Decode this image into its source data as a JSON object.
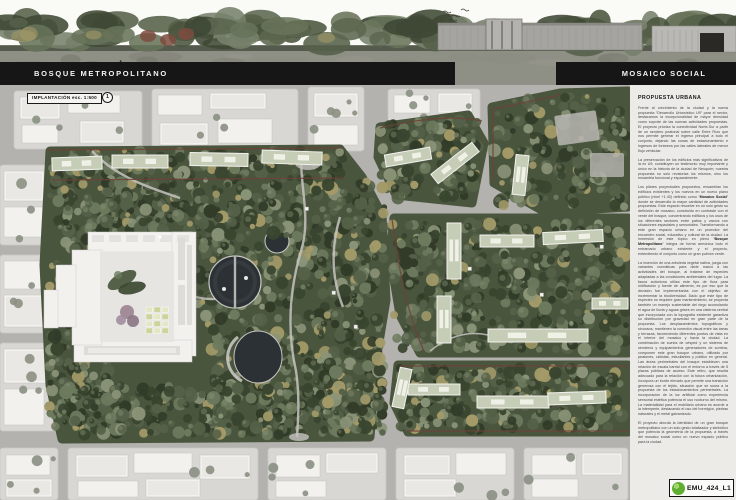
{
  "board": {
    "title_left": "BOSQUE METROPOLITANO",
    "title_right": "MOSAICO SOCIAL",
    "plan_label": "IMPLANTACIÓN esc. 1:500",
    "plan_marker": "1",
    "sheet_code": "EMU_424_L1"
  },
  "panel": {
    "heading": "PROPUESTA URBANA",
    "bold_terms": [
      "Mosaico Social",
      "Bosque Metropolitano"
    ],
    "paragraphs": [
      "Frente al crecimiento de la ciudad y la nueva propuesta “Desarrollo Urbanístico U9” para el sector, destacamos la excepcionalidad de mayor densidad como soporte de las nuevas actividades propuestas. El proyecto prioriza la conectividad Norte-Sur a partir de un sendero peatonal sobre calle Entre Ríos que nos permite generar el ingreso principal a todo el conjunto, dejando las zonas de estacionamiento e ingresos de foráneos por las calles laterales de menor flujo vehicular.",
      "La preservación de los edificios más significativos de la ex U9, constituyen un testimonio muy importante y único en la historia de la ciudad de Neuquén; nuestra propuesta no solo revaloriza los mismos, sino los ensambla funcional y espacialmente.",
      "Los pilares proyectuales propuestos, ensamblan los edificios existentes y los nuevos en un nuevo plano público (nivel +1.40) definido como “Mosaico Social” donde se desarrolla la mayor cantidad de actividades propuestas. Este espacio resuelve en un solo gesto su definición de mosaico, construido en contraste con el verde del bosque, concentrando edificios y los usos de los diferentes sectores entre patios y vacíos con situaciones espaciales y sensoriales. Transformando a este gran espacio urbano en un promotor del encuentro social, educativo y cultural de la ciudad. La inmersión de este tópico en pleno “Bosque Metropolitano” integra de forma armónica todo el entramado urbano existente y el proyecto, entendiendo el conjunto como un gran pulmón verde.",
      "La inserción de una arboleda vegetal nativa, juega con variantes cromáticas para darle marco a las actividades del bosque, al tratarse de especies adaptadas a las condiciones ambientales del lugar. La fauna autóctona utiliza este tipo de flora para nidificación y fuente de alimento, es por eso que la decisión fue implementarlas con el objetivo de incrementar la biodiversidad. Dado que este tipo de especies no requiere gran mantenimiento, se proyecta también un manejo sustentable del riego acumulando el agua de lluvia y aguas grises en una cisterna central que incorporada con la topografía existente garantiza su distribución por gravedad en gran parte de la propuesta. Los desplazamientos topográficos y sinuosos, mantienen la conexión visual entre las áreas y terrazas, favoreciendo diferentes puntos de vista en el interior del mosaico y hacia la ciudad. La combinación de suelos de césped y un sistema de senderos y equipamientos generadores de sombra, componen este gran bosque urbano, utilizado por peatones, ciclistas, estudiantes y público en general. Las áreas perimetrales del bosque establecen una relación de escala barrial con el entorno a través de 5 plazas públicas de acceso. Este retiro, que resulta adecuado para la relación con la futura urbanización, incorpora un borde elevado que permite una transición generosa con el tejido, situación que se suma a la propuesta de los estacionamientos perimetrales. La incorporación de la luz artificial como experiencia sensorial estética potencia el uso nocturno del mismo. La materialidad para el mobiliario urbano es acorde a la intemperie, destacando el uso del hormigón, piedras naturales y el metal galvanizado.",
      "El proyecto aborda la identidad de un gran bosque metropolitano con un solo gesto totalizador y simbólico que potencia la geometría de la propuesta, a través del mosaico social como un nuevo espacio público para la ciudad."
    ]
  },
  "palette": {
    "bar_bg": "#161616",
    "bar_text": "#f4f4f2",
    "paper": "#edebe7",
    "street": "#b3b2af",
    "block": "#d8d7d4",
    "building_white": "#f2f1ee",
    "park_base": "#4a553e",
    "tree_dark": "#39452f",
    "tree_xdark": "#313b28",
    "tree_mid": "#556148",
    "tree_light": "#6d7a5e",
    "tree_pale": "#8b9478",
    "tree_khaki": "#a39a68",
    "sage_roof": "#c6cdb7",
    "pond": "#2b3134",
    "path": "#c5c4c0",
    "plaza": "#b8b7b3",
    "edge_red": "#6f4237",
    "city_tree": "#8c9184",
    "logo_green": "#5fae2f",
    "pano_sky": "#fafaf7",
    "pano_ground": "#8e8f85",
    "pano_building": "#a5a4a0"
  }
}
